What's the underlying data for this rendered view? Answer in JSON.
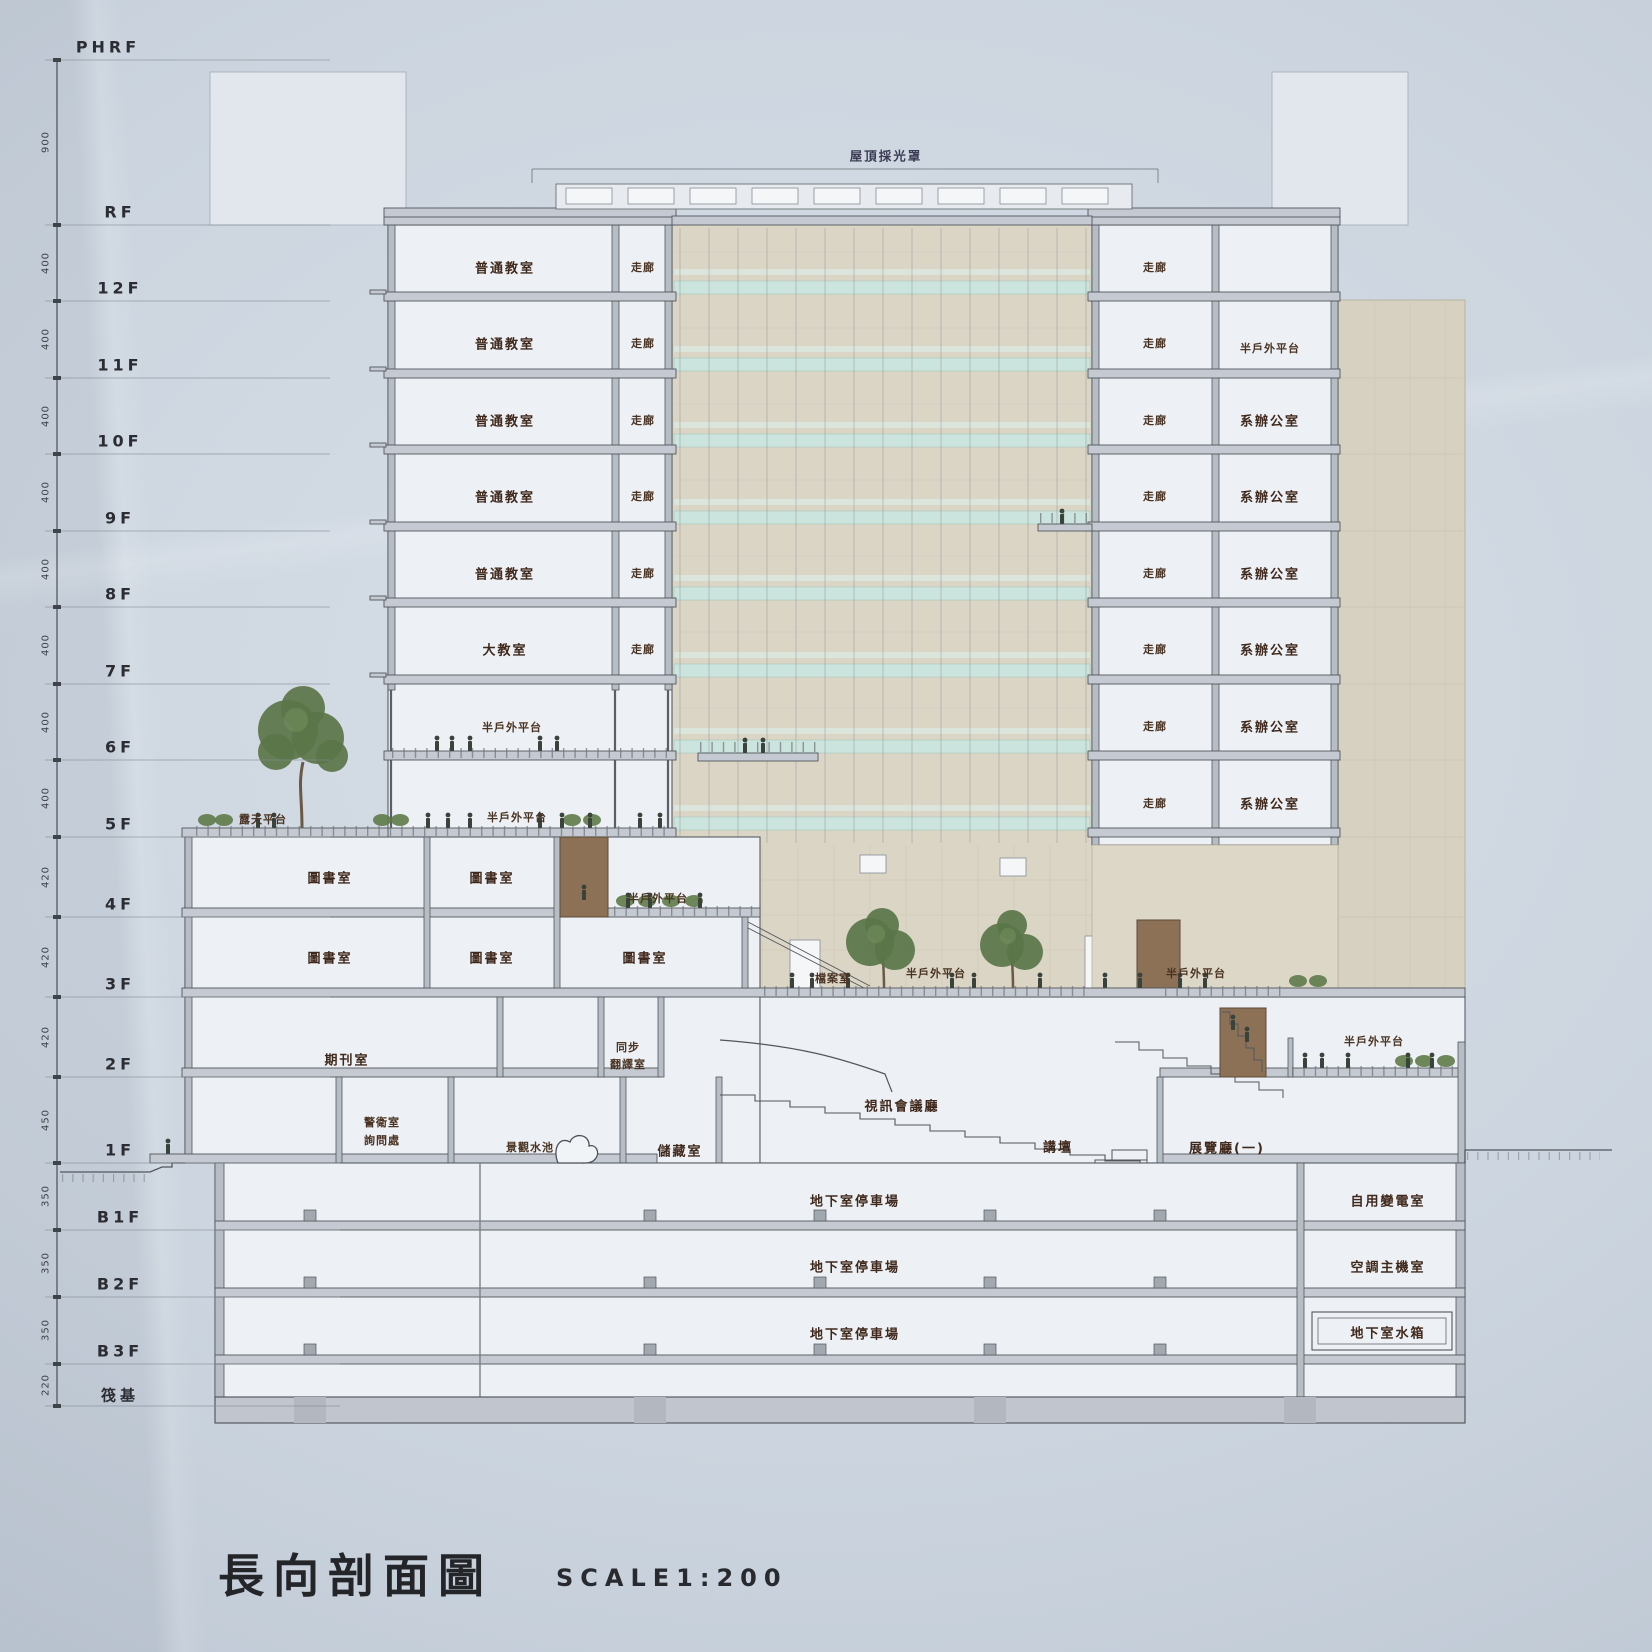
{
  "window": {
    "title": "長向剖面圖",
    "scale_label": "SCALE1:200"
  },
  "annotations": {
    "skylight": "屋頂採光罩"
  },
  "ruler": {
    "floors": [
      "PHRF",
      "RF",
      "12F",
      "11F",
      "10F",
      "9F",
      "8F",
      "7F",
      "6F",
      "5F",
      "4F",
      "3F",
      "2F",
      "1F",
      "B1F",
      "B2F",
      "B3F",
      "筏基"
    ],
    "dims": [
      "900",
      "400",
      "400",
      "400",
      "400",
      "400",
      "400",
      "400",
      "400",
      "420",
      "420",
      "420",
      "450",
      "350",
      "350",
      "350",
      "220"
    ]
  },
  "rooms": {
    "classroom": "普通教室",
    "big_classroom": "大教室",
    "corridor": "走廊",
    "dept_office": "系辦公室",
    "semi_outdoor_deck": "半戶外平台",
    "open_roof_deck": "露天平台",
    "library": "圖書室",
    "archives": "檔案室",
    "periodicals": "期刊室",
    "sync_line1": "同步",
    "sync_line2": "翻譯室",
    "guard_line1": "警衛室",
    "guard_line2": "詢問處",
    "landscape_pool": "景觀水池",
    "storage": "儲藏室",
    "av_conference_hall": "視訊會議廳",
    "lectern": "講壇",
    "exhibition_hall_1": "展覽廳(一)",
    "basement_parking": "地下室停車場",
    "transformer_room": "自用變電室",
    "hvac_room": "空調主機室",
    "water_tank": "地下室水箱"
  },
  "colors": {
    "paper": "#ccd5df",
    "ink": "#2b2d32",
    "line": "#52565c",
    "glass_band": "#cbe4dd",
    "atrium_wall": "#dbd5c5",
    "room_fill": "#edf1f5",
    "label_brown": "#40291c",
    "stair_brown": "#8c7156",
    "tree_green": "#5a7548"
  }
}
